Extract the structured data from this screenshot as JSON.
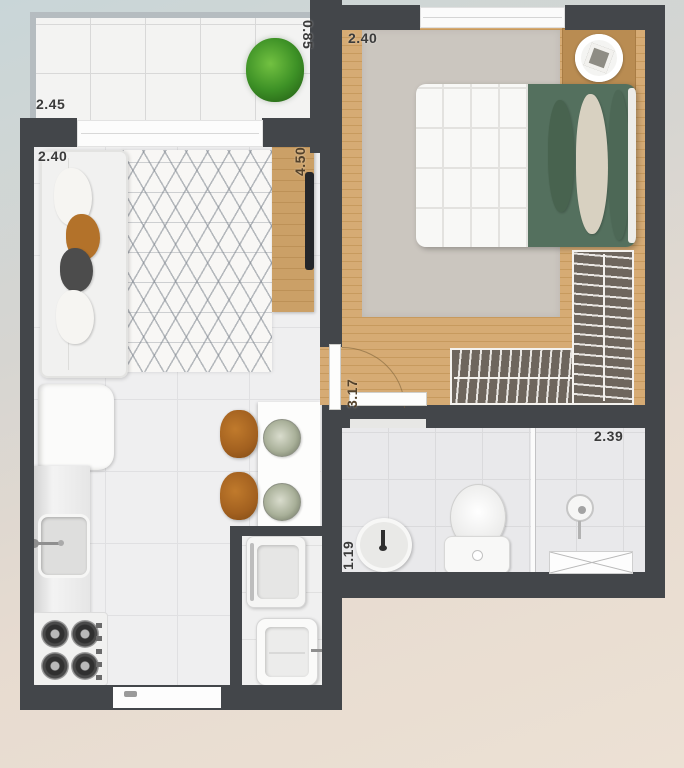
{
  "plan": {
    "type": "apartment-floor-plan",
    "dimensions": {
      "balcony_width": "2.45",
      "balcony_depth": "0.85",
      "living_width": "2.40",
      "living_length": "4.50",
      "bedroom_width": "2.40",
      "bedroom_length": "3.17",
      "bathroom_width": "1.19",
      "suite_width": "2.39"
    },
    "rooms": [
      "balcony",
      "living-room",
      "kitchen",
      "bedroom",
      "closet",
      "bathroom",
      "laundry"
    ],
    "furniture": [
      "potted-plant",
      "sofa",
      "geometric-rug",
      "tv-sideboard",
      "tv",
      "double-bed",
      "nightstand",
      "wardrobe-hangers",
      "breakfast-counter",
      "stools",
      "plates",
      "refrigerator",
      "kitchen-sink",
      "stove",
      "washing-machine",
      "laundry-tank",
      "round-basin",
      "toilet",
      "shower"
    ],
    "colors": {
      "wall": "#43464a",
      "wood_floor": "#d0a46c",
      "bedroom_rug": "#cbc6bf",
      "bedding_green": "#54705e",
      "stool_brown": "#a2601f",
      "background_top": "#c9d6d8",
      "background_bottom": "#ece1d4"
    }
  }
}
